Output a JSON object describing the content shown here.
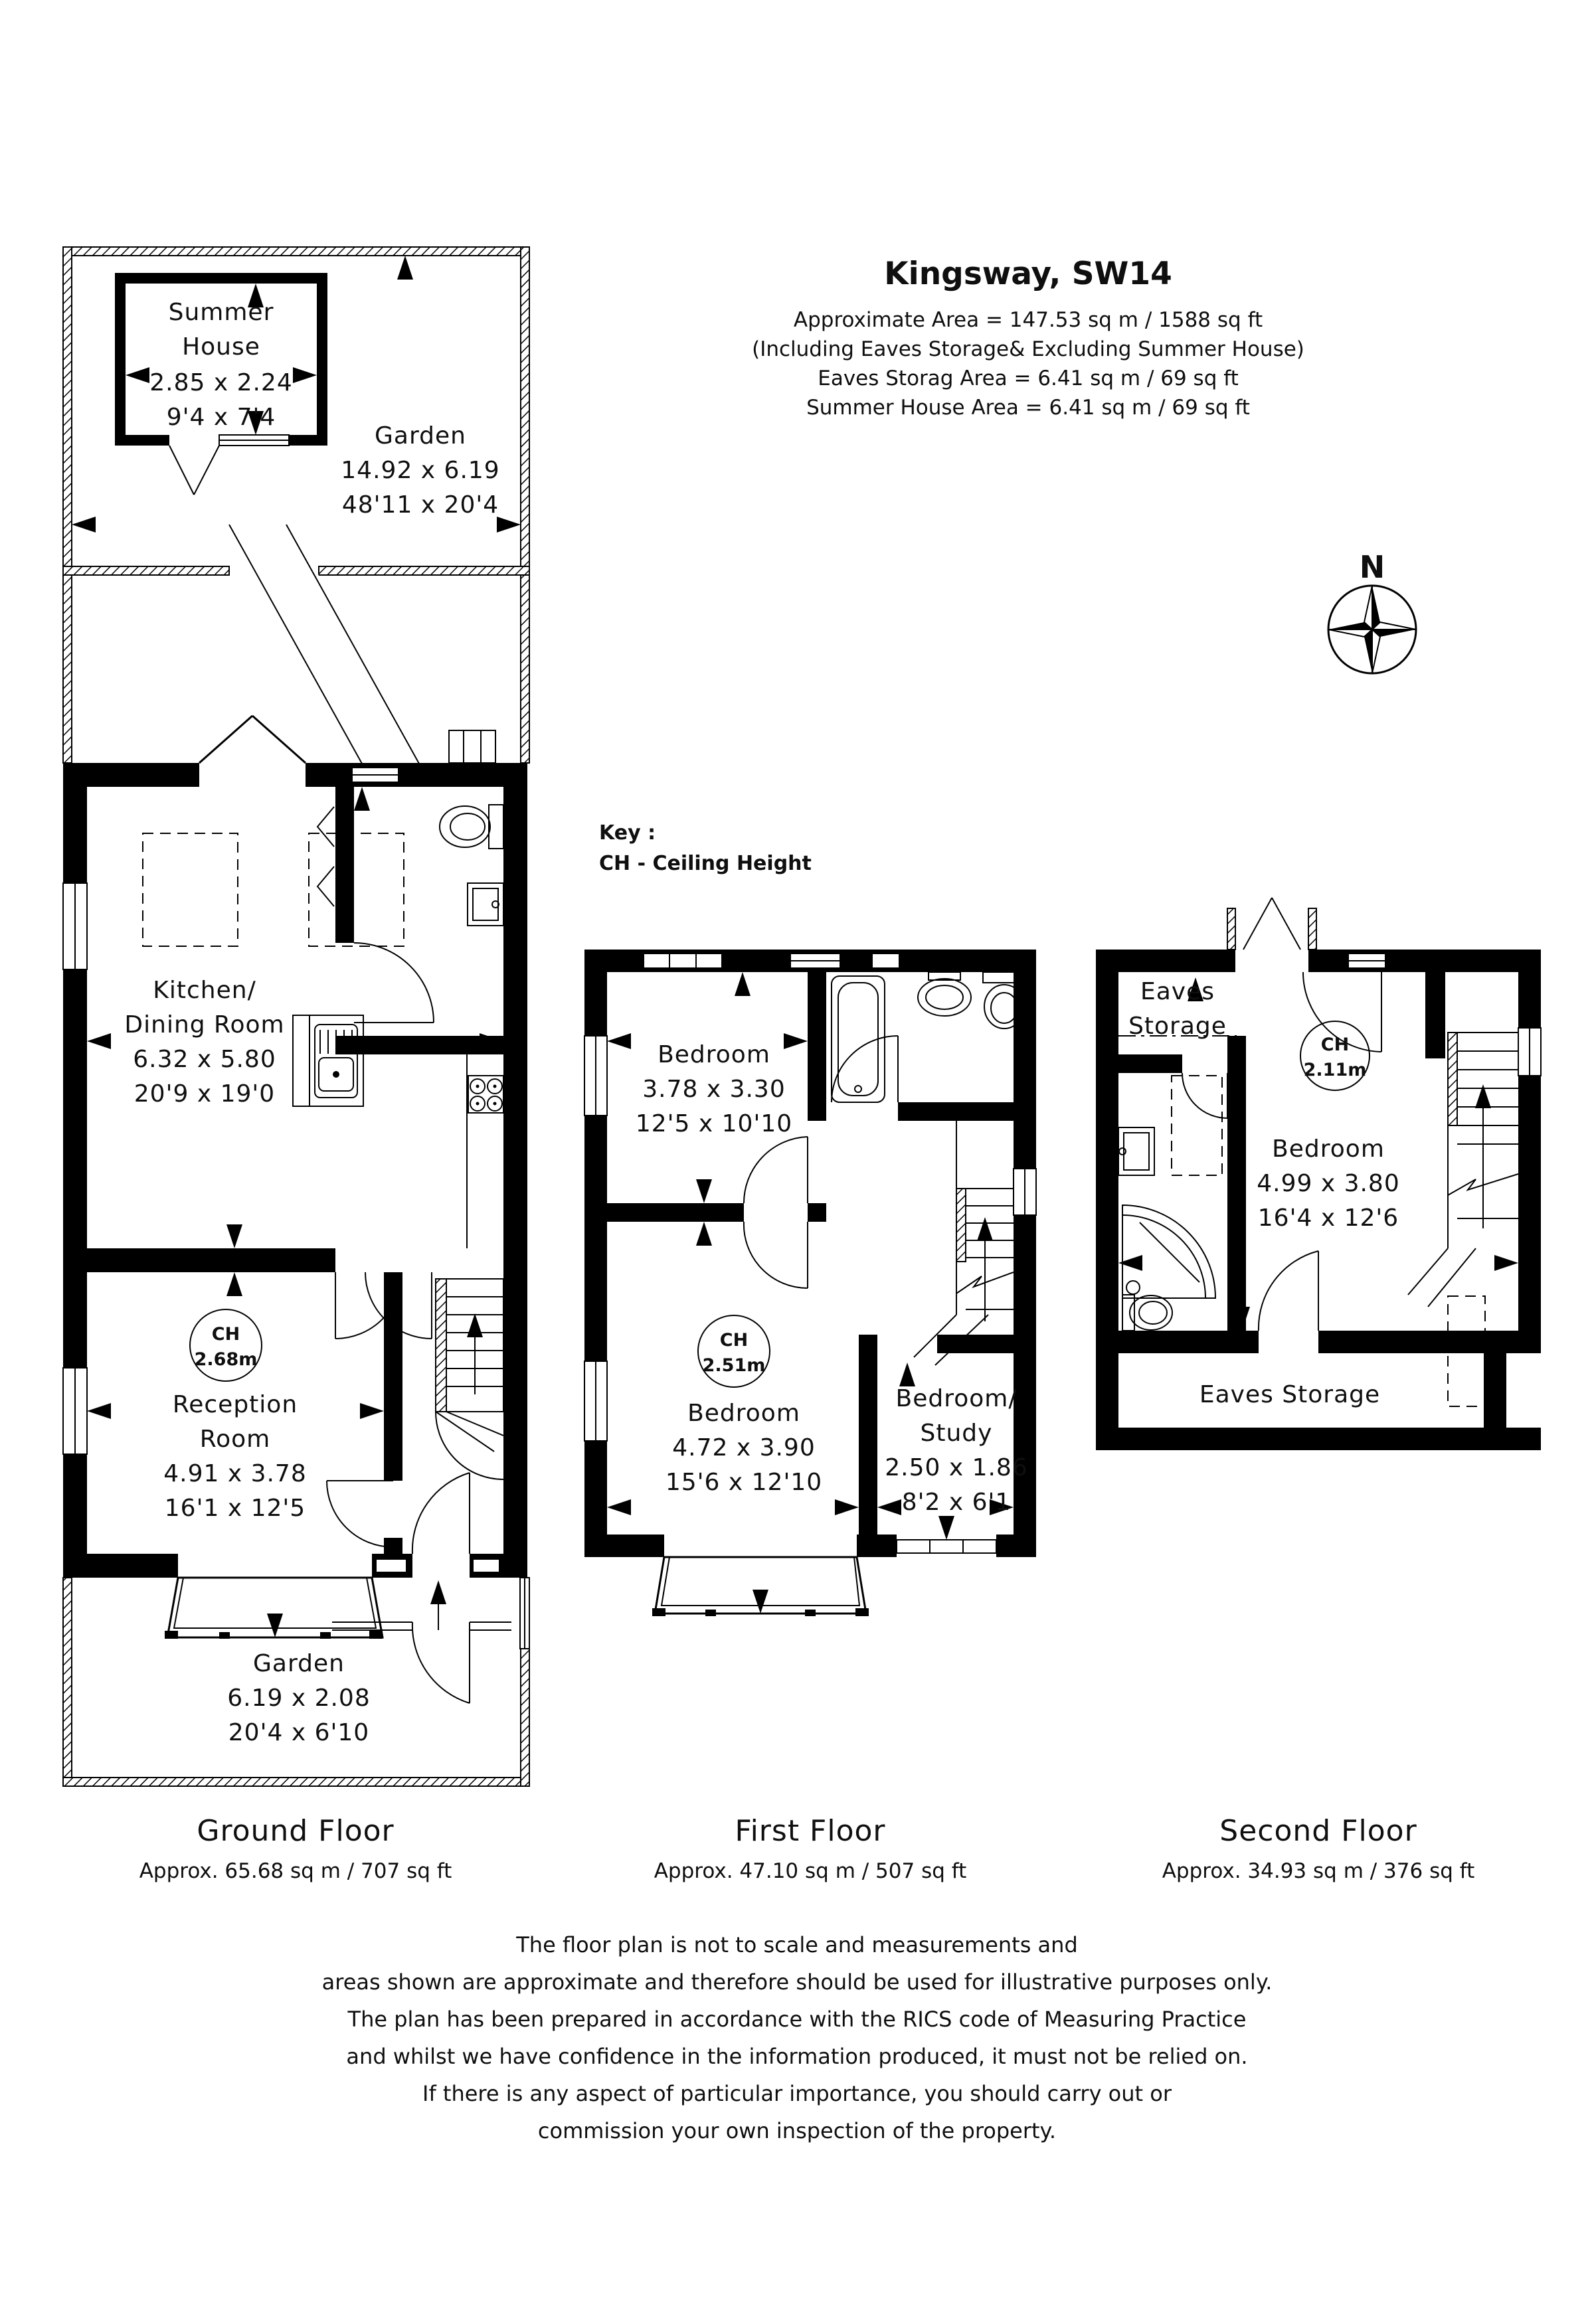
{
  "title": "Kingsway, SW14",
  "header": {
    "line1": "Approximate Area = 147.53 sq m / 1588 sq ft",
    "line2": "(Including Eaves Storage& Excluding Summer House)",
    "line3": "Eaves Storag Area = 6.41 sq m / 69 sq ft",
    "line4": "Summer House Area = 6.41 sq m / 69 sq ft"
  },
  "compass": {
    "north": "N"
  },
  "key": {
    "heading": "Key :",
    "entry": "CH - Ceiling Height"
  },
  "floors": {
    "ground": {
      "name": "Ground Floor",
      "area": "Approx. 65.68 sq m / 707 sq ft"
    },
    "first": {
      "name": "First Floor",
      "area": "Approx. 47.10 sq m / 507 sq ft"
    },
    "second": {
      "name": "Second Floor",
      "area": "Approx. 34.93 sq m / 376 sq ft"
    }
  },
  "rooms": {
    "summer_house": {
      "l1": "Summer",
      "l2": "House",
      "m": "2.85 x 2.24",
      "ft": "9'4 x 7'4"
    },
    "garden_rear": {
      "l1": "Garden",
      "m": "14.92 x 6.19",
      "ft": "48'11 x 20'4"
    },
    "kitchen": {
      "l1": "Kitchen/",
      "l2": "Dining Room",
      "m": "6.32 x 5.80",
      "ft": "20'9 x 19'0"
    },
    "reception": {
      "ch": "CH",
      "chv": "2.68m",
      "l1": "Reception",
      "l2": "Room",
      "m": "4.91 x 3.78",
      "ft": "16'1 x 12'5"
    },
    "garden_front": {
      "l1": "Garden",
      "m": "6.19 x 2.08",
      "ft": "20'4 x 6'10"
    },
    "bedroom_f1": {
      "l1": "Bedroom",
      "m": "3.78 x 3.30",
      "ft": "12'5 x 10'10"
    },
    "bedroom_f2": {
      "ch": "CH",
      "chv": "2.51m",
      "l1": "Bedroom",
      "m": "4.72 x 3.90",
      "ft": "15'6 x 12'10"
    },
    "study": {
      "l1": "Bedroom/",
      "l2": "Study",
      "m": "2.50 x 1.86",
      "ft": "8'2 x 6'1"
    },
    "eaves_top": {
      "l1": "Eaves",
      "l2": "Storage"
    },
    "bedroom_s": {
      "ch": "CH",
      "chv": "2.11m",
      "l1": "Bedroom",
      "m": "4.99 x 3.80",
      "ft": "16'4 x 12'6"
    },
    "eaves_bottom": {
      "l1": "Eaves Storage"
    }
  },
  "disclaimer": [
    "The floor plan is not to scale and measurements and",
    "areas shown are approximate and therefore should be used for illustrative purposes only.",
    "The plan has been prepared in accordance with the RICS code of Measuring Practice",
    "and whilst we have confidence in the information produced, it must not be relied on.",
    "If there is any aspect of particular importance, you should carry out or",
    "commission your own inspection of the property."
  ]
}
